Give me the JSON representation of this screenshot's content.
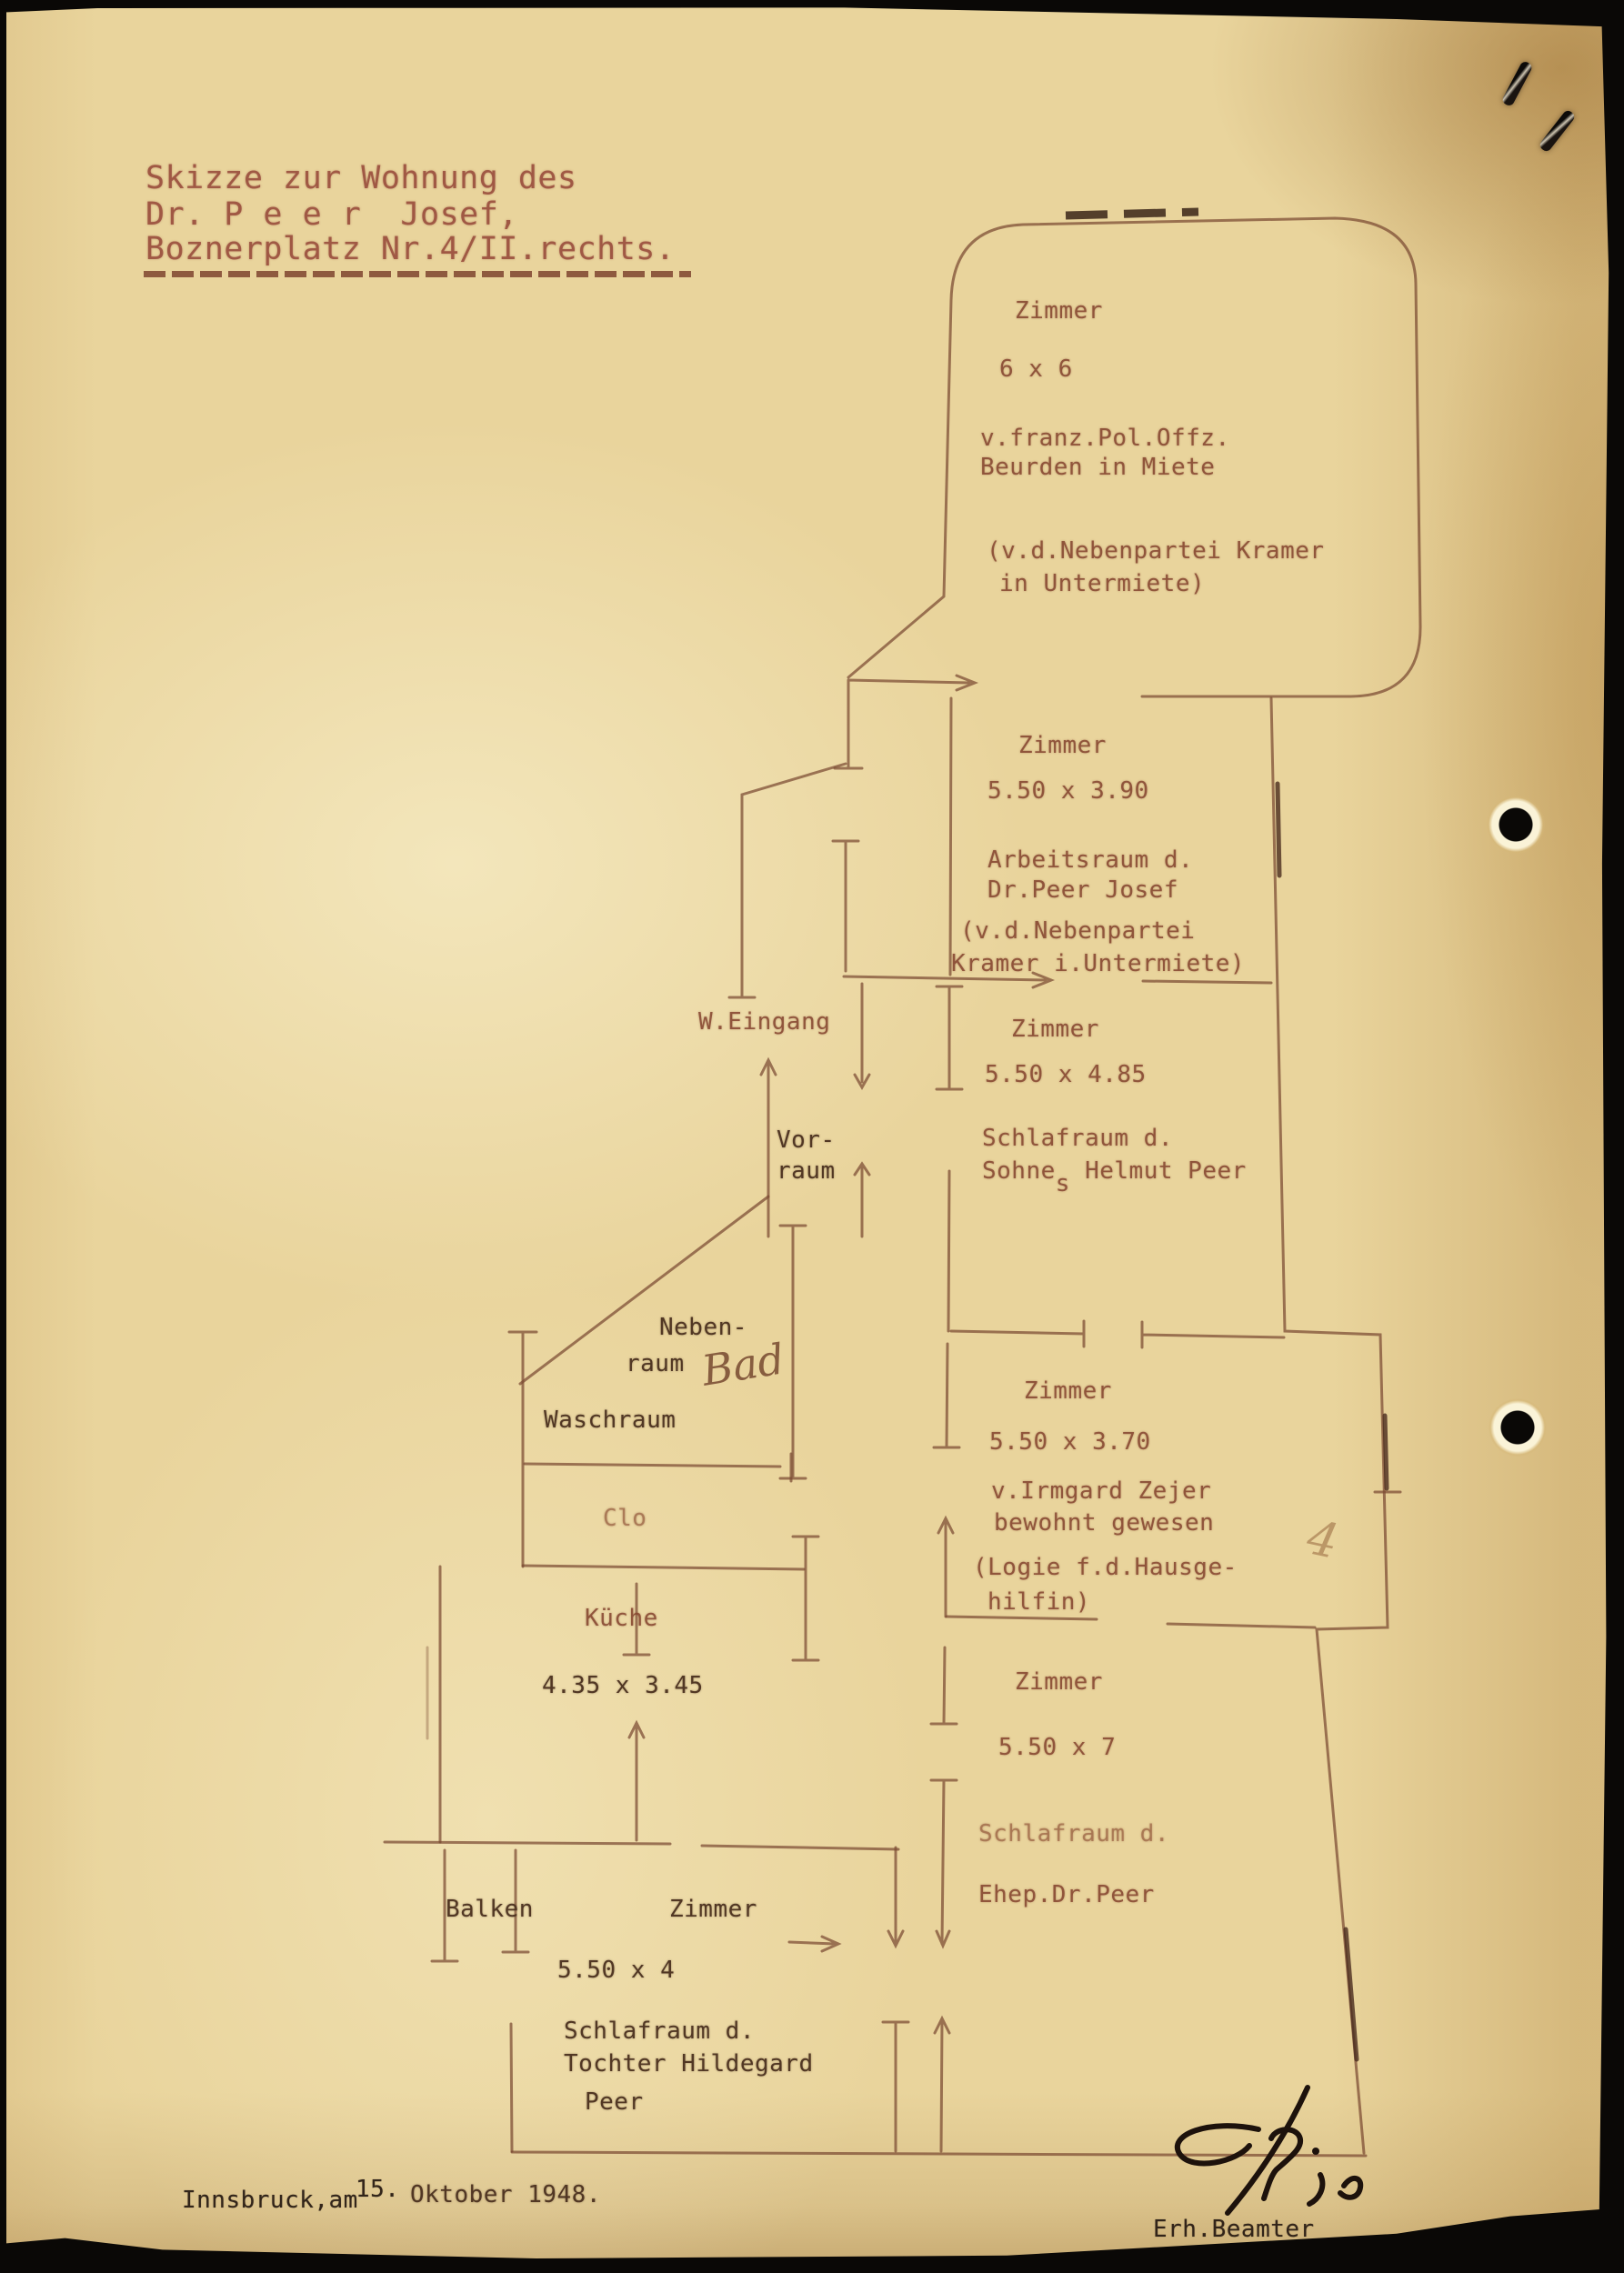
{
  "header": {
    "line1": "Skizze zur Wohnung des",
    "line2": "Dr. P e e r  Josef,",
    "line3": "Boznerplatz Nr.4/II.rechts."
  },
  "rooms": {
    "big": {
      "name": "Zimmer",
      "size": "6 x 6",
      "tenant1": "v.franz.Pol.Offz.",
      "tenant2": "Beurden in Miete",
      "sub1": "(v.d.Nebenpartei Kramer",
      "sub2": "in Untermiete)"
    },
    "zimmer390": {
      "name": "Zimmer",
      "size": "5.50 x 3.90",
      "use1": "Arbeitsraum d.",
      "use2": "Dr.Peer Josef",
      "sub1": "(v.d.Nebenpartei",
      "sub2": "Kramer i.Untermiete)"
    },
    "eingang": {
      "label": "W.Eingang"
    },
    "zimmer485": {
      "name": "Zimmer",
      "size": "5.50 x 4.85",
      "use1": "Schlafraum d.",
      "use2a": "Sohne",
      "use2sub": "s",
      "use2b": " Helmut Peer"
    },
    "vorraum": {
      "line1": "Vor-",
      "line2": "raum"
    },
    "nebenraum": {
      "line1": "Neben-",
      "line2": "raum",
      "handwritten": "Bad"
    },
    "waschraum": {
      "label": "Waschraum"
    },
    "clo": {
      "label": "Clo"
    },
    "kueche": {
      "name": "Küche",
      "size": "4.35 x 3.45"
    },
    "zimmer370": {
      "name": "Zimmer",
      "size": "5.50 x 3.70",
      "use1": "v.Irmgard Zejer",
      "use2": "bewohnt gewesen",
      "sub1": "(Logie f.d.Hausge-",
      "sub2": "hilfin)"
    },
    "zimmer7": {
      "name": "Zimmer",
      "size": "5.50 x 7",
      "use1": "Schlafraum d.",
      "use2": "Ehep.Dr.Peer"
    },
    "balkon": {
      "label": "Balken"
    },
    "zimmer4": {
      "name": "Zimmer",
      "size": "5.50 x 4",
      "use1": "Schlafraum d.",
      "use2": "Tochter Hildegard",
      "use3": "Peer"
    }
  },
  "annotations": {
    "pencil4": "4"
  },
  "footer": {
    "place": "Innsbruck,am",
    "day": "15.",
    "monthyear": "Oktober 1948.",
    "signed": "Erh.Beamter"
  }
}
